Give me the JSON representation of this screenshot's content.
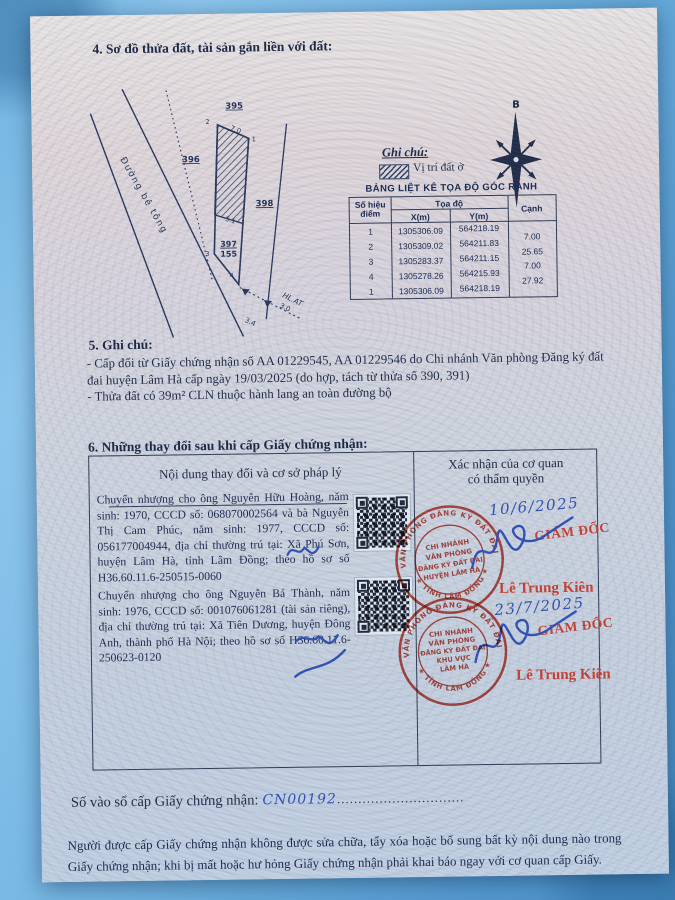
{
  "section4_title": "4. Sơ đồ thửa đất, tài sản gắn liền với đất:",
  "diagram": {
    "road_label": "Đường bê tông",
    "parcels": {
      "a": "395",
      "b": "396",
      "c": "398"
    },
    "plot_number": "397",
    "plot_area": "155",
    "corners": {
      "c1": "1",
      "c2": "2",
      "c3": "3",
      "c4": "4"
    },
    "dims": {
      "top": "7.0",
      "mid": "5.1",
      "d1": "3.4",
      "d2": "3.0"
    },
    "hlat": "HL.AT",
    "compass_north": "B"
  },
  "legend": {
    "heading": "Ghi chú:",
    "residential": "Vị trí đất ở"
  },
  "coord_table": {
    "title": "BẢNG LIỆT KÊ TỌA ĐỘ GÓC RANH",
    "col_point_l1": "Số hiệu",
    "col_point_l2": "điểm",
    "col_coord": "Tọa độ",
    "col_x": "X(m)",
    "col_y": "Y(m)",
    "col_edge": "Cạnh",
    "rows": [
      {
        "p": "1",
        "x": "1305306.09",
        "y": "564218.19"
      },
      {
        "p": "2",
        "x": "1305309.02",
        "y": "564211.83"
      },
      {
        "p": "3",
        "x": "1305283.37",
        "y": "564211.15"
      },
      {
        "p": "4",
        "x": "1305278.26",
        "y": "564215.93"
      },
      {
        "p": "1",
        "x": "1305306.09",
        "y": "564218.19"
      }
    ],
    "edges": [
      "7.00",
      "25.65",
      "7.00",
      "27.92"
    ]
  },
  "section5": {
    "title": "5. Ghi chú:",
    "line1": "- Cấp đổi từ Giấy chứng nhận số AA 01229545, AA 01229546 do Chi nhánh Văn phòng Đăng ký đất đai huyện Lâm Hà cấp ngày 19/03/2025 (do hợp, tách từ thửa số 390, 391)",
    "line2": "- Thửa đất có 39m² CLN thuộc hành lang an toàn đường bộ"
  },
  "section6": {
    "title": "6. Những thay đổi sau khi cấp Giấy chứng nhận:",
    "col1_header": "Nội dung thay đổi và cơ sở pháp lý",
    "col2_header_l1": "Xác nhận của cơ quan",
    "col2_header_l2": "có thẩm quyền",
    "entry1": "Chuyển nhượng cho ông Nguyễn Hữu Hoàng, năm sinh: 1970, CCCD số: 068070002564 và bà Nguyễn Thị Cam Phúc, năm sinh: 1977, CCCD số: 056177004944, địa chỉ thường trú tại: Xã Phú Sơn, huyện Lâm Hà, tỉnh Lâm Đồng; theo hồ sơ số H36.60.11.6-250515-0060",
    "entry2": "Chuyển nhượng cho ông Nguyễn Bá Thành, năm sinh: 1976, CCCD số: 001076061281 (tài sản riêng), địa chỉ thường trú tại: Xã Tiên Dương, huyện Đông Anh, thành phố Hà Nội; theo hồ sơ số H36.60.11.6-250623-0120",
    "confirmations": [
      {
        "date": "10/6/2025",
        "title": "GIÁM ĐỐC",
        "name": "Lê Trung Kiên"
      },
      {
        "date": "23/7/2025",
        "title": "GIÁM ĐỐC",
        "name": "Lê Trung Kiên"
      }
    ],
    "stamps": [
      {
        "arc_top": "VĂN PHÒNG ĐĂNG KÝ ĐẤT ĐAI",
        "arc_bottom": "★ TỈNH LÂM ĐỒNG ★",
        "l1": "CHI NHÁNH",
        "l2": "VĂN PHÒNG",
        "l3": "ĐĂNG KÝ ĐẤT ĐAI",
        "l4": "HUYỆN LÂM HÀ",
        "l5": ""
      },
      {
        "arc_top": "VĂN PHÒNG ĐĂNG KÝ ĐẤT ĐAI",
        "arc_bottom": "★ TỈNH LÂM ĐỒNG ★",
        "l1": "CHI NHÁNH",
        "l2": "VĂN PHÒNG",
        "l3": "ĐĂNG KÝ ĐẤT ĐAI",
        "l4": "KHU VỰC",
        "l5": "LÂM HÀ"
      }
    ]
  },
  "footer": {
    "serial_label": "Số vào sổ cấp Giấy chứng nhận:",
    "serial_value": "CN00192",
    "dots": "..............................",
    "notice": "Người được cấp Giấy chứng nhận không được sửa chữa, tẩy xóa hoặc bổ sung bất kỳ nội dung nào trong Giấy chứng nhận; khi bị mất hoặc hư hỏng Giấy chứng nhận phải khai báo ngay với cơ quan cấp Giấy."
  },
  "colors": {
    "stamp_red": "#c23b2e",
    "ink_blue": "#2b4db0",
    "text_navy": "#16213f",
    "background_blue": "#69aedd"
  }
}
